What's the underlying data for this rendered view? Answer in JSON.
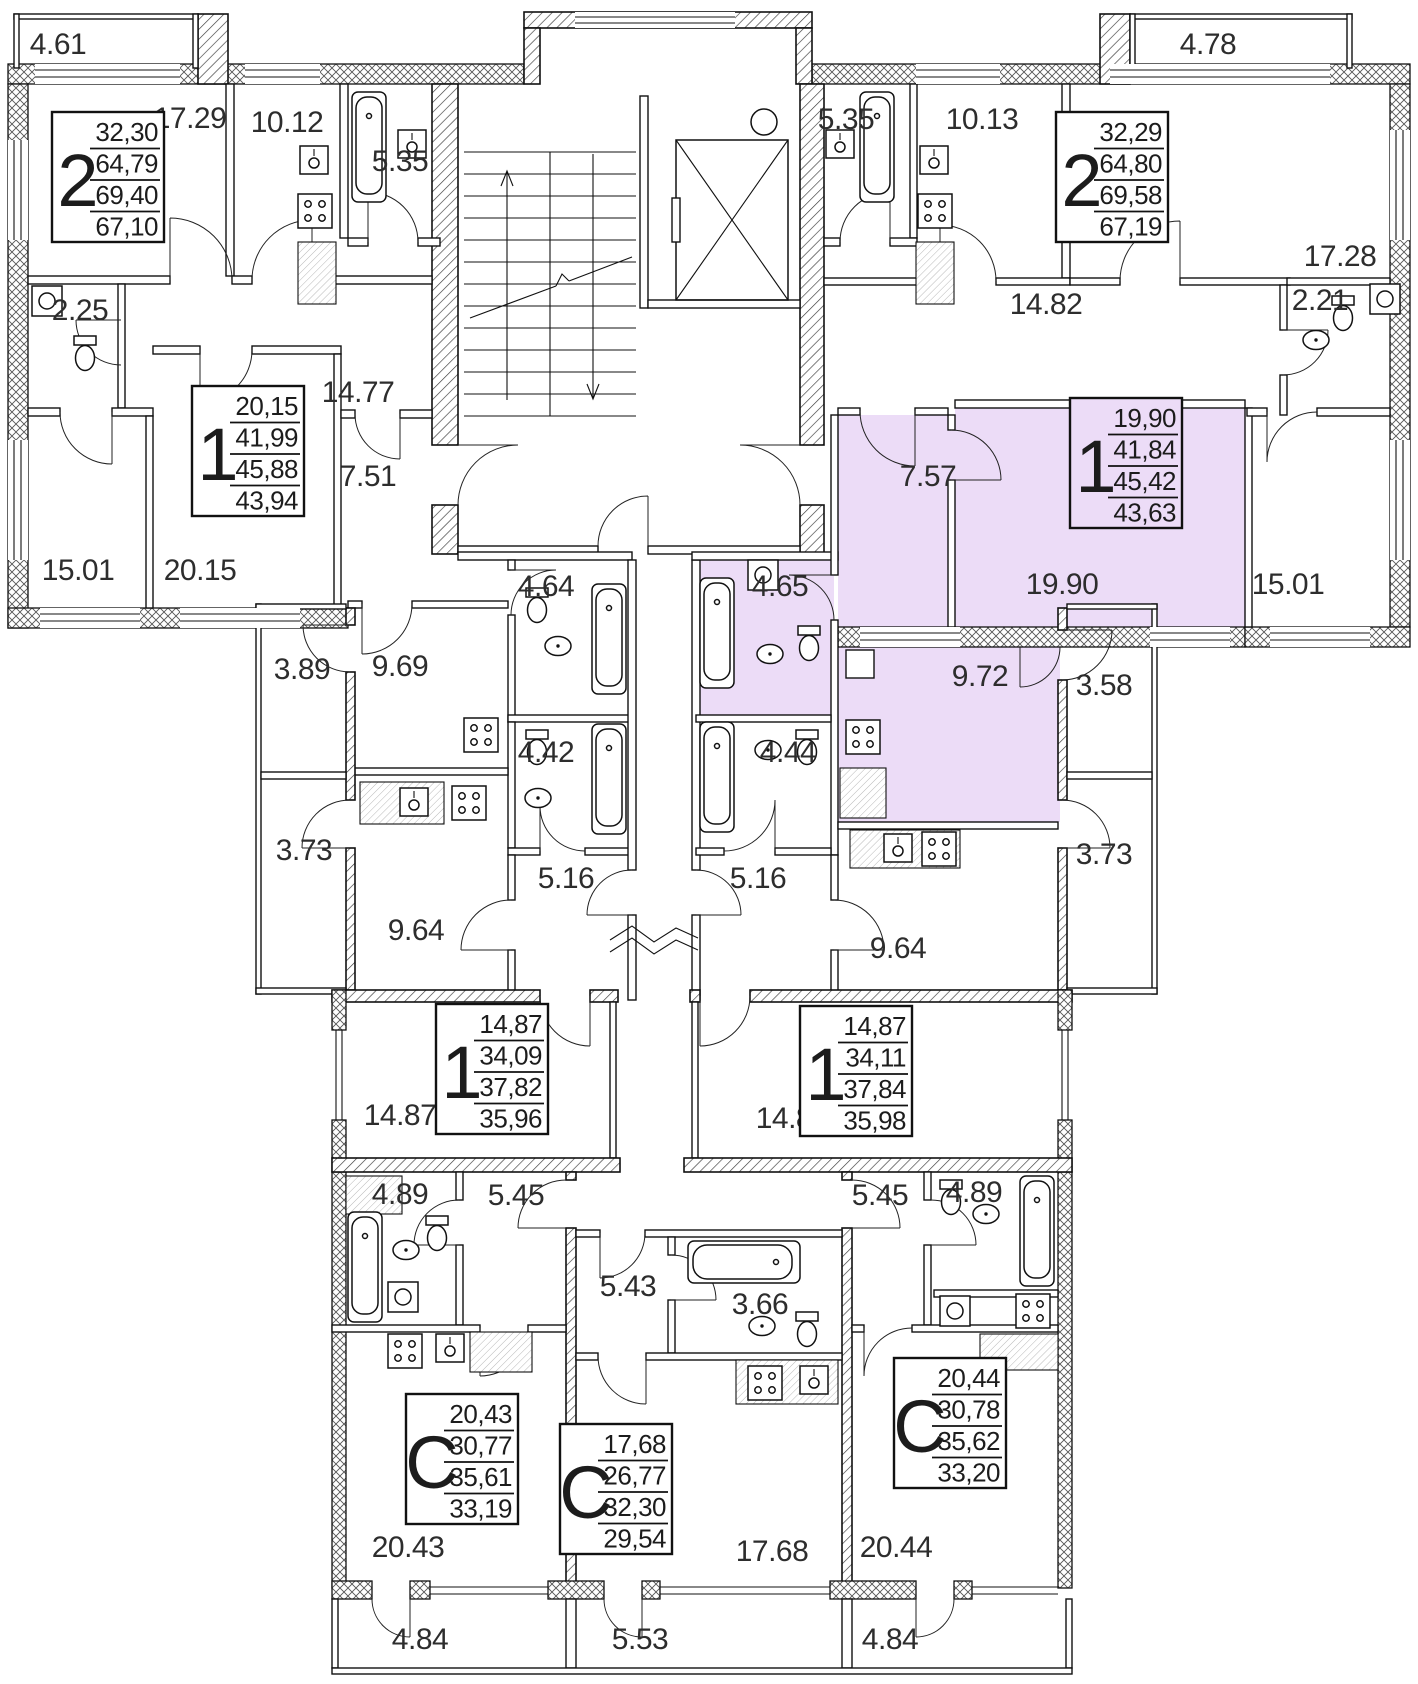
{
  "highlight": {
    "color": "#ecdcf7"
  },
  "stamps": [
    {
      "id": "apt-2-left",
      "type": "2",
      "values": [
        "32,30",
        "64,79",
        "69,40",
        "67,10"
      ],
      "x": 52,
      "y": 112,
      "highlighted": false
    },
    {
      "id": "apt-2-right",
      "type": "2",
      "values": [
        "32,29",
        "64,80",
        "69,58",
        "67,19"
      ],
      "x": 1056,
      "y": 112,
      "highlighted": false
    },
    {
      "id": "apt-1-left",
      "type": "1",
      "values": [
        "20,15",
        "41,99",
        "45,88",
        "43,94"
      ],
      "x": 192,
      "y": 386,
      "highlighted": false
    },
    {
      "id": "apt-1-right",
      "type": "1",
      "values": [
        "19,90",
        "41,84",
        "45,42",
        "43,63"
      ],
      "x": 1070,
      "y": 398,
      "highlighted": true
    },
    {
      "id": "apt-1-mid-left",
      "type": "1",
      "values": [
        "14,87",
        "34,09",
        "37,82",
        "35,96"
      ],
      "x": 436,
      "y": 1004,
      "highlighted": false
    },
    {
      "id": "apt-1-mid-right",
      "type": "1",
      "values": [
        "14,87",
        "34,11",
        "37,84",
        "35,98"
      ],
      "x": 800,
      "y": 1006,
      "highlighted": false
    },
    {
      "id": "apt-c-left",
      "type": "C",
      "values": [
        "20,43",
        "30,77",
        "35,61",
        "33,19"
      ],
      "x": 406,
      "y": 1394,
      "highlighted": false
    },
    {
      "id": "apt-c-mid",
      "type": "C",
      "values": [
        "17,68",
        "26,77",
        "32,30",
        "29,54"
      ],
      "x": 560,
      "y": 1424,
      "highlighted": false
    },
    {
      "id": "apt-c-right",
      "type": "C",
      "values": [
        "20,44",
        "30,78",
        "35,62",
        "33,20"
      ],
      "x": 894,
      "y": 1358,
      "highlighted": false
    }
  ],
  "room_labels": [
    {
      "t": "4.61",
      "x": 58,
      "y": 46
    },
    {
      "t": "17.29",
      "x": 190,
      "y": 120
    },
    {
      "t": "10.12",
      "x": 287,
      "y": 124
    },
    {
      "t": "5.35",
      "x": 400,
      "y": 163
    },
    {
      "t": "2.25",
      "x": 80,
      "y": 312
    },
    {
      "t": "14.77",
      "x": 358,
      "y": 394
    },
    {
      "t": "7.51",
      "x": 368,
      "y": 478
    },
    {
      "t": "15.01",
      "x": 78,
      "y": 572
    },
    {
      "t": "20.15",
      "x": 200,
      "y": 572
    },
    {
      "t": "3.89",
      "x": 302,
      "y": 671
    },
    {
      "t": "9.69",
      "x": 400,
      "y": 668
    },
    {
      "t": "4.64",
      "x": 546,
      "y": 588
    },
    {
      "t": "4.42",
      "x": 546,
      "y": 754
    },
    {
      "t": "3.73",
      "x": 304,
      "y": 852
    },
    {
      "t": "5.16",
      "x": 566,
      "y": 880
    },
    {
      "t": "9.64",
      "x": 416,
      "y": 932
    },
    {
      "t": "14.87",
      "x": 400,
      "y": 1117
    },
    {
      "t": "4.89",
      "x": 400,
      "y": 1196
    },
    {
      "t": "5.45",
      "x": 516,
      "y": 1197
    },
    {
      "t": "5.43",
      "x": 628,
      "y": 1288
    },
    {
      "t": "3.66",
      "x": 760,
      "y": 1306
    },
    {
      "t": "20.43",
      "x": 408,
      "y": 1549
    },
    {
      "t": "17.68",
      "x": 772,
      "y": 1553
    },
    {
      "t": "4.84",
      "x": 420,
      "y": 1641
    },
    {
      "t": "5.53",
      "x": 640,
      "y": 1641
    },
    {
      "t": "4.84",
      "x": 890,
      "y": 1641
    },
    {
      "t": "20.44",
      "x": 896,
      "y": 1549
    },
    {
      "t": "14.87",
      "x": 792,
      "y": 1120
    },
    {
      "t": "5.45",
      "x": 880,
      "y": 1197
    },
    {
      "t": "4.89",
      "x": 974,
      "y": 1194
    },
    {
      "t": "5.16",
      "x": 758,
      "y": 880
    },
    {
      "t": "9.64",
      "x": 898,
      "y": 950
    },
    {
      "t": "9.72",
      "x": 980,
      "y": 678
    },
    {
      "t": "4.65",
      "x": 780,
      "y": 588
    },
    {
      "t": "4.44",
      "x": 788,
      "y": 754
    },
    {
      "t": "3.58",
      "x": 1104,
      "y": 687
    },
    {
      "t": "3.73",
      "x": 1104,
      "y": 856
    },
    {
      "t": "19.90",
      "x": 1062,
      "y": 586
    },
    {
      "t": "15.01",
      "x": 1288,
      "y": 586
    },
    {
      "t": "7.57",
      "x": 928,
      "y": 478
    },
    {
      "t": "14.82",
      "x": 1046,
      "y": 306
    },
    {
      "t": "2.21",
      "x": 1320,
      "y": 302
    },
    {
      "t": "17.28",
      "x": 1340,
      "y": 258
    },
    {
      "t": "10.13",
      "x": 982,
      "y": 121
    },
    {
      "t": "5.35",
      "x": 846,
      "y": 121
    },
    {
      "t": "4.78",
      "x": 1208,
      "y": 46
    }
  ]
}
